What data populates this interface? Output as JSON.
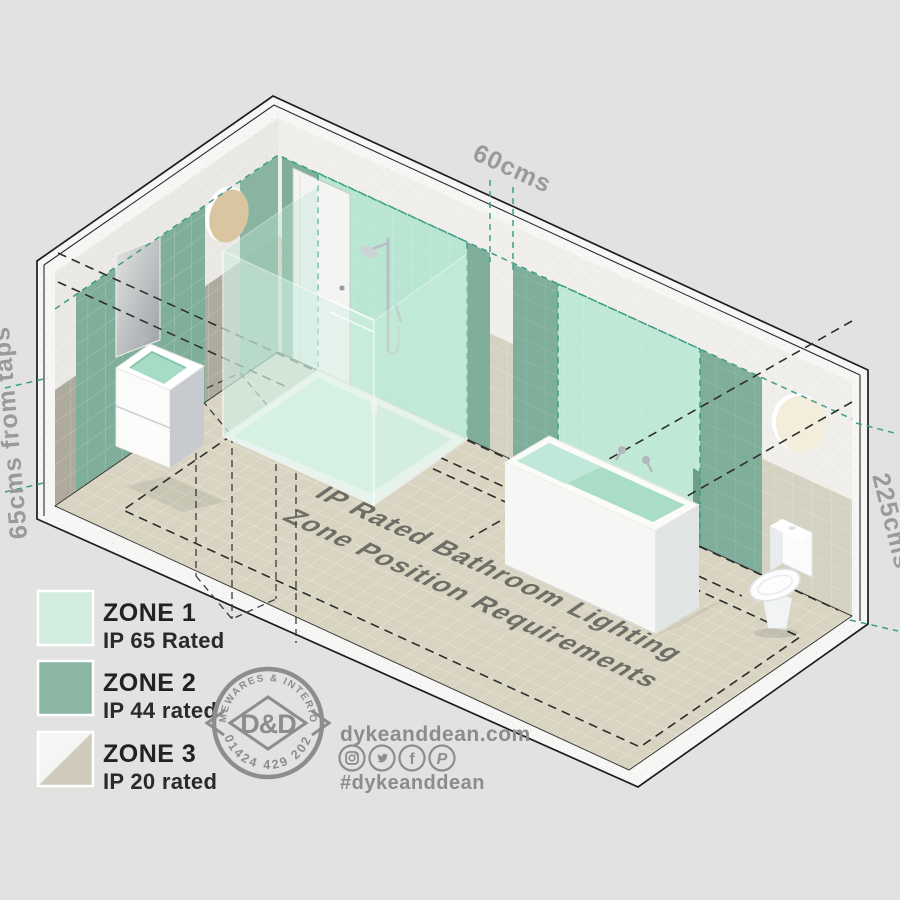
{
  "title": {
    "line1": "IP Rated Bathroom Lighting",
    "line2": "Zone Position Requirements"
  },
  "dimensions": {
    "top": "60cms",
    "left": "65cms from taps",
    "right": "225cms"
  },
  "legend": {
    "items": [
      {
        "zone": "ZONE 1",
        "rating": "IP 65 Rated",
        "color": "#d3ece0"
      },
      {
        "zone": "ZONE 2",
        "rating": "IP 44 rated",
        "color": "#8ab6a3"
      },
      {
        "zone": "ZONE 3",
        "rating": "IP 20 rated",
        "color_top": "#f5f5f3",
        "color_bottom": "#cfcabc"
      }
    ]
  },
  "logo": {
    "arc_top": "HOMEWARES & INTERIORS",
    "arc_bottom": "01424 429 202",
    "monogram": "D&D"
  },
  "contact": {
    "website": "dykeanddean.com",
    "hashtag": "#dykeanddean",
    "social": [
      {
        "name": "instagram-icon"
      },
      {
        "name": "twitter-icon"
      },
      {
        "name": "facebook-icon",
        "glyph": "f"
      },
      {
        "name": "pinterest-icon",
        "glyph": "P"
      }
    ]
  },
  "colors": {
    "zone1_wall_shower": "#b9e6d2",
    "zone1_wall_bath": "#bfe9d6",
    "zone2_wall": "#7fae9a",
    "floor": "#d8d4c1",
    "teal_dash": "#3f9e85",
    "dim_text": "#9a9a9a"
  }
}
